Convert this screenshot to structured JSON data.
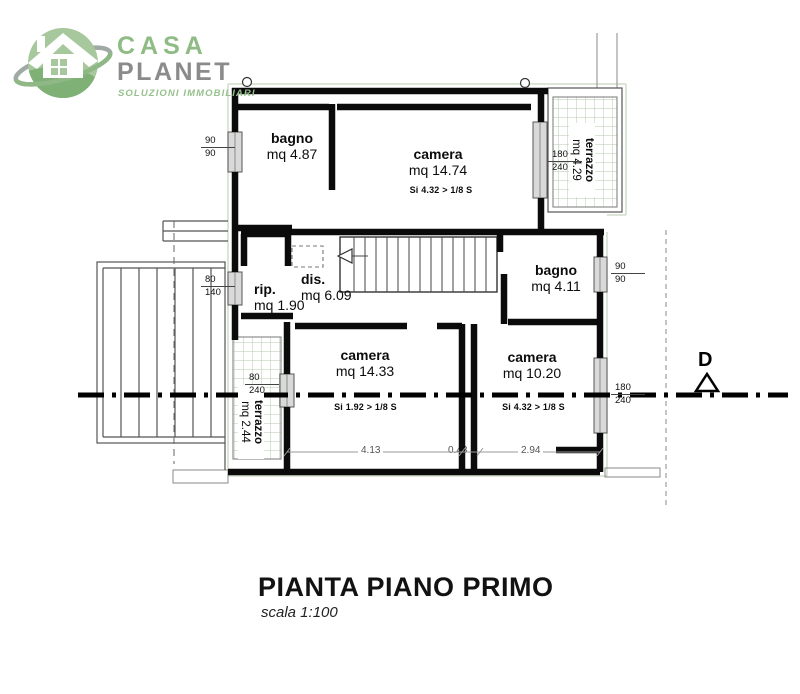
{
  "logo": {
    "brand_line1": "CASA",
    "brand_line2": "PLANET",
    "tagline": "SOLUZIONI IMMOBILIARI"
  },
  "plan": {
    "rooms": [
      {
        "name": "bagno",
        "area": "mq 4.87"
      },
      {
        "name": "camera",
        "area": "mq 14.74",
        "note": "Si 4.32 > 1/8 S"
      },
      {
        "name": "terrazzo",
        "area": "mq 4.29"
      },
      {
        "name": "rip.",
        "area": "mq 1.90"
      },
      {
        "name": "dis.",
        "area": "mq 6.09"
      },
      {
        "name": "bagno",
        "area": "mq 4.11"
      },
      {
        "name": "camera",
        "area": "mq 14.33",
        "note": "Si 1.92 > 1/8 S"
      },
      {
        "name": "camera",
        "area": "mq 10.20",
        "note": "Si 4.32 > 1/8 S"
      },
      {
        "name": "terrazzo",
        "area": "mq 2.44"
      }
    ],
    "openings": [
      {
        "w": "90",
        "h": "90"
      },
      {
        "w": "80",
        "h": "140"
      },
      {
        "w": "80",
        "h": "240"
      },
      {
        "w": "180",
        "h": "240"
      },
      {
        "w": "90",
        "h": "90"
      },
      {
        "w": "180",
        "h": "240"
      }
    ],
    "floor_dims": [
      "4.13",
      "0.43",
      "2.94"
    ],
    "section_marker": "D"
  },
  "title": {
    "main": "PIANTA PIANO PRIMO",
    "scale": "scala 1:100"
  },
  "colors": {
    "logo_green": "#8fbc85",
    "logo_gray": "#8b8b8b",
    "wall_black": "#0b0b0b",
    "grid_green": "#b7cbaf"
  }
}
